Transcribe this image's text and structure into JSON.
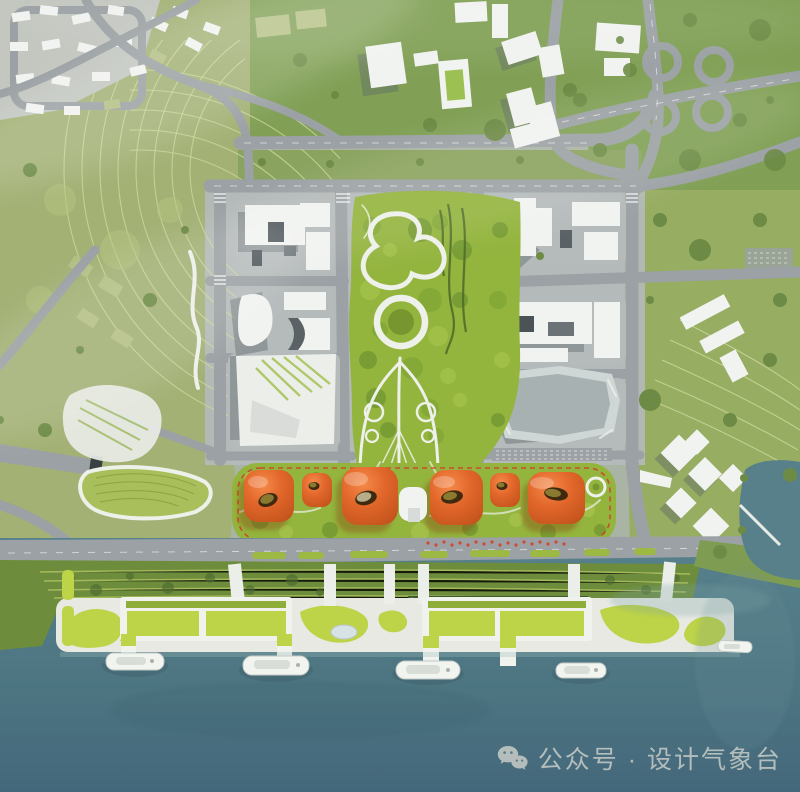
{
  "image": {
    "type": "aerial-masterplan-rendering",
    "description": "Bird's-eye architectural rendering of a waterfront urban masterplan: gray city blocks flanking a central green park, a row of orange pavilion buildings with courtyard openings on a landscaped strip outlined by a red dashed site boundary, a layered quay esplanade with green-roof piers and ferries on a teal river, surrounded by green hills, terraced slopes, roads and a highway interchange.",
    "width": 800,
    "height": 792
  },
  "watermark": {
    "icon": "wechat-icon",
    "text": "公众号 · 设计气象台",
    "color": "#ccd0ca"
  },
  "palette": {
    "water": "#517b86",
    "waterDeep": "#476e7b",
    "park": "#93b43d",
    "quay": "#bdd348",
    "lawn": "#6d8d3c",
    "olive": "#a3b175",
    "rside": "#97ad61",
    "forest": "#81a055",
    "tree": "#6d8b45",
    "pad": "#b5babb",
    "road": "#9ba1a4",
    "bldgw": "#f1f3f0",
    "shadow": "#5e666a",
    "orange": "#e0662b",
    "reddash": "#d23b2b",
    "watermark": "#ccd0ca"
  },
  "scene": {
    "regions": [
      "hillside-neighborhood-top-left",
      "boulevard-and-offices-top-center",
      "highway-interchange-top-right",
      "left-city-blocks",
      "central-park",
      "right-city-blocks",
      "orange-pavilion-strip",
      "waterfront-esplanade",
      "green-roof-piers",
      "river-with-ferries"
    ],
    "counts": {
      "orange_pavilions": 6,
      "ferry_boats": 5,
      "green_roof_piers": 2
    }
  }
}
